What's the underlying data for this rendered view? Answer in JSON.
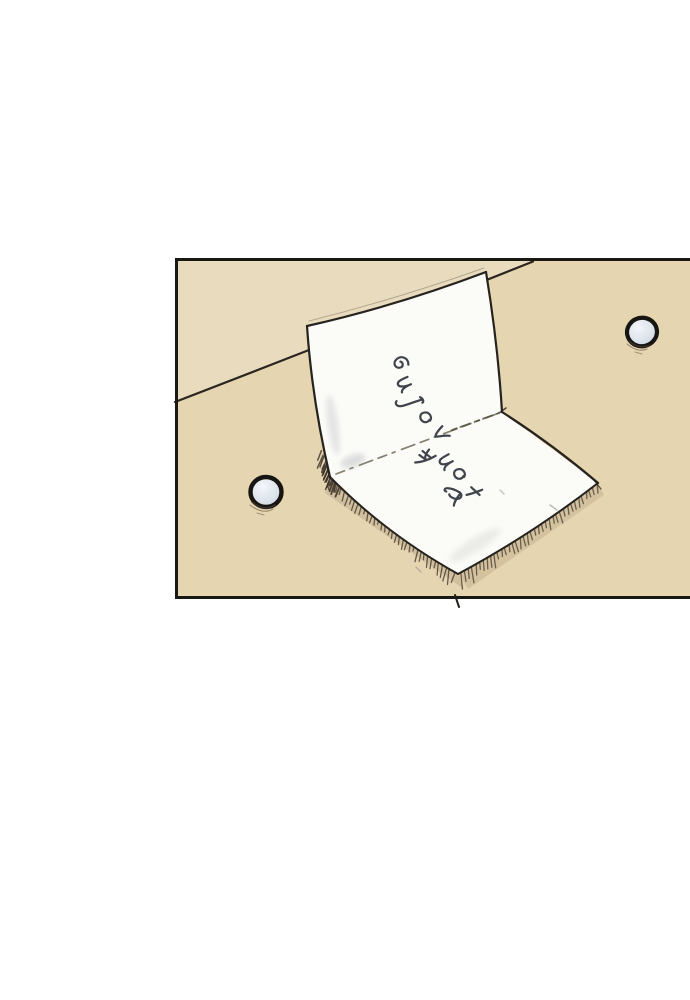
{
  "page": {
    "background_color": "#ffffff",
    "kind": "webtoon comic panel page"
  },
  "panel": {
    "alt": "A folded white paper note standing open like a tent on a tan tabletop, with a short slanted handwritten message on it. Two small round metal buttons or magnets rest on the table, one to the lower left and one to the upper right. A diagonal line marks the edge of the table surface.",
    "border_color": "#1a1813",
    "colors": {
      "surface": "#e6d5b1",
      "surface_upper": "#e9dcbe",
      "paper": "#fbfbf8",
      "ink": "#3f434b",
      "outline": "#26231f",
      "hatch": "#4e4337",
      "button_fill": "#dfe5ed"
    },
    "handwriting": {
      "legible": false,
      "lines": 2,
      "description": "Two short diagonal lines of stylized cursive handwriting on the folded note; strokes are decorative and not clearly legible."
    },
    "objects": {
      "paper_note": "folded paper note (tent fold) with handwritten message and cast shadow drawn as pen hatching",
      "button_left": "small round button or magnet, pale blue-grey with black outline",
      "button_right": "small round button or magnet, pale blue-grey with black outline",
      "table_edge": "diagonal sketched line separating two surface planes"
    }
  }
}
